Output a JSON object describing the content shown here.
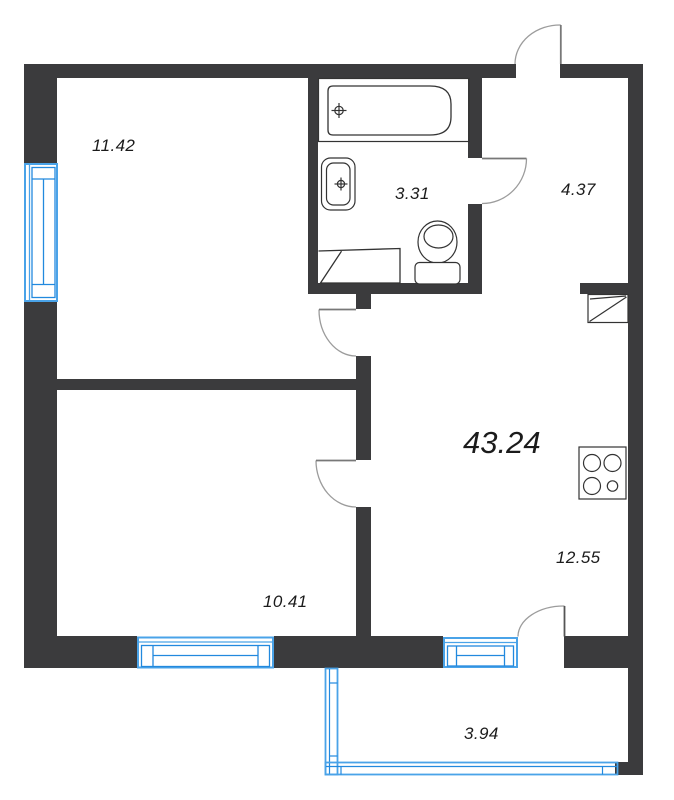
{
  "total_area": "43.24",
  "rooms": {
    "room_top_left": "11.42",
    "bathroom": "3.31",
    "hallway": "4.37",
    "kitchen_living": "12.55",
    "room_bottom_left": "10.41",
    "balcony": "3.94"
  },
  "colors": {
    "wall": "#3b3b3d",
    "glazing": "#4aa3e8",
    "glazing_frame": "#2289de",
    "fixture_outline": "#333333",
    "door_arc": "#9c9c9c",
    "door_leaf": "#787878",
    "label_text": "#1b1b1b",
    "background": "#ffffff"
  }
}
